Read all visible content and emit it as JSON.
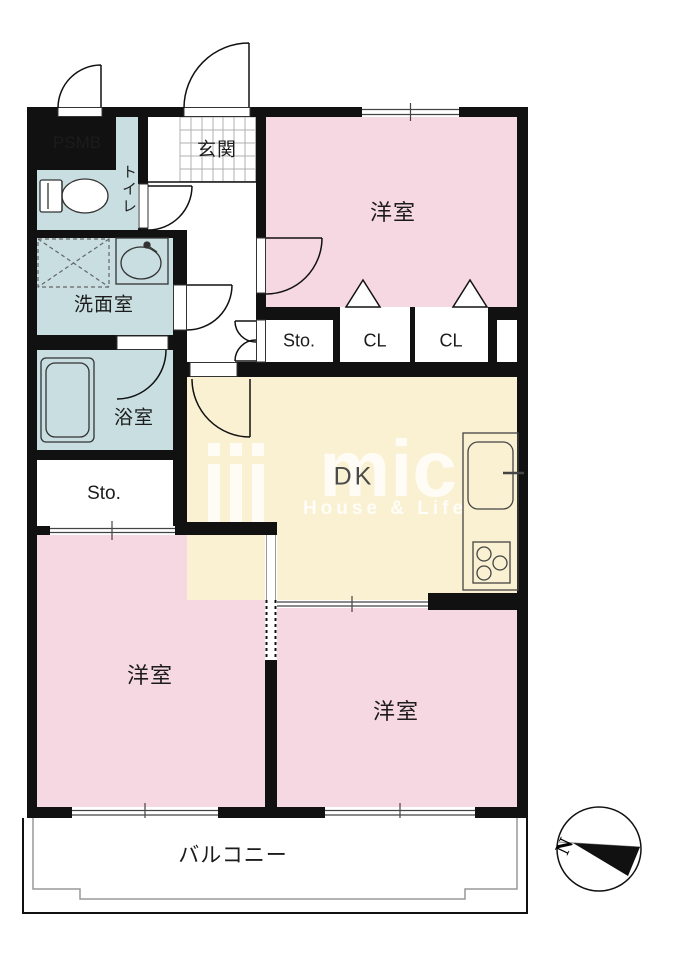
{
  "plan": {
    "rooms": {
      "entrance": "玄関",
      "toilet": "トイレ",
      "washroom": "洗面室",
      "bathroom": "浴室",
      "storage_left": "Sto.",
      "storage_hall": "Sto.",
      "closet_1": "CL",
      "closet_2": "CL",
      "pipe_space": "PSMB",
      "dining_kitchen": "DK",
      "bedroom_north": "洋室",
      "bedroom_southwest": "洋室",
      "bedroom_southeast": "洋室",
      "balcony": "バルコニー"
    },
    "compass": {
      "north_label": "N"
    },
    "watermark": {
      "logo_text": "mic",
      "tagline": "House & Life"
    },
    "colors": {
      "bedroom_pink": "#f6d8e3",
      "dining_kitchen_cream": "#faf0d2",
      "wet_area_blue": "#c8dee1",
      "wall_black": "#111111"
    }
  }
}
